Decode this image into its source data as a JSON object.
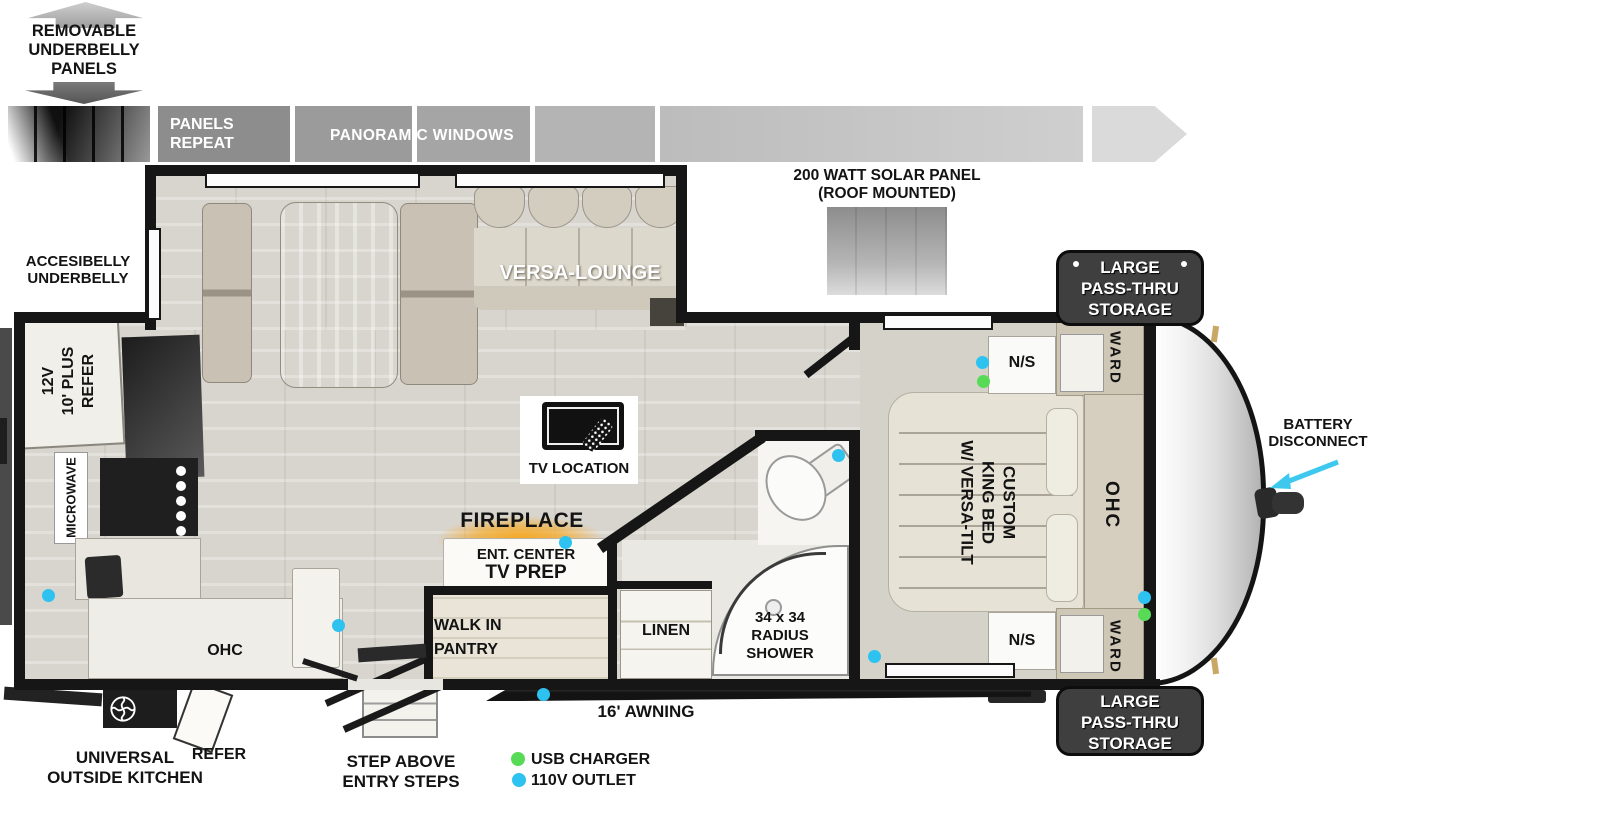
{
  "removable_note": {
    "l1": "REMOVABLE",
    "l2": "UNDERBELLY",
    "l3": "PANELS"
  },
  "strip": {
    "repeat_l1": "PANELS",
    "repeat_l2": "REPEAT",
    "panoramic": "PANORAMIC WINDOWS"
  },
  "solar": {
    "l1": "200 WATT SOLAR PANEL",
    "l2": "(ROOF MOUNTED)"
  },
  "accessible_note": {
    "l1": "ACCESIBELLY",
    "l2": "UNDERBELLY"
  },
  "storage_front_top": {
    "l1": "LARGE",
    "l2": "PASS-THRU",
    "l3": "STORAGE"
  },
  "storage_front_bottom": {
    "l1": "LARGE",
    "l2": "PASS-THRU",
    "l3": "STORAGE"
  },
  "battery": {
    "l1": "BATTERY",
    "l2": "DISCONNECT"
  },
  "living": {
    "versa_lounge": "VERSA-LOUNGE",
    "tv_location": "TV LOCATION",
    "fireplace": "FIREPLACE",
    "ent_center_l1": "ENT. CENTER",
    "ent_center_l2": "TV PREP",
    "pantry_l1": "WALK IN",
    "pantry_l2": "PANTRY"
  },
  "kitchen": {
    "refer_l1": "12V",
    "refer_l2": "10' PLUS",
    "refer_l3": "REFER",
    "microwave": "MICROWAVE",
    "ohc": "OHC"
  },
  "bath": {
    "linen": "LINEN",
    "shower_l1": "34 x 34",
    "shower_l2": "RADIUS",
    "shower_l3": "SHOWER"
  },
  "bedroom": {
    "bed_l1": "CUSTOM",
    "bed_l2": "KING BED",
    "bed_l3": "W/ VERSA-TILT",
    "ns_top": "N/S",
    "ns_bottom": "N/S",
    "ward_top": "WARD",
    "ward_bottom": "WARD",
    "ohc": "OHC"
  },
  "exterior": {
    "awning": "16' AWNING",
    "steps_l1": "STEP ABOVE",
    "steps_l2": "ENTRY STEPS",
    "outside_kitchen_l1": "UNIVERSAL",
    "outside_kitchen_l2": "OUTSIDE KITCHEN",
    "outside_refer": "REFER"
  },
  "legend": {
    "usb": "USB CHARGER",
    "outlet": "110V OUTLET"
  },
  "colors": {
    "usb_green": "#57DB57",
    "outlet_blue": "#2EC2F0",
    "battery_arrow": "#3EC8EE",
    "fireplace_glow": "#F6A821",
    "wall": "#161616"
  }
}
